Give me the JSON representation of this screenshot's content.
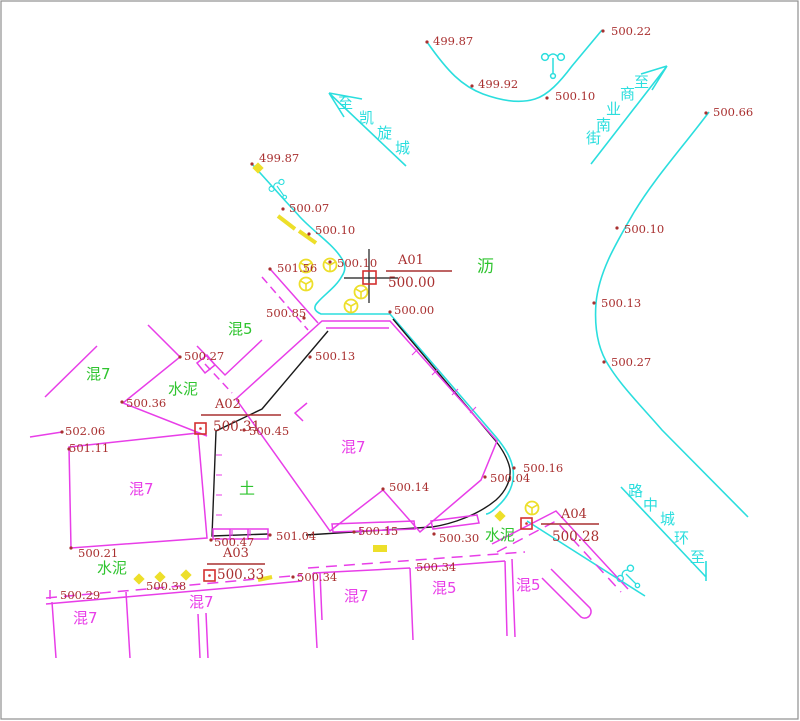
{
  "drawing_type": "cadastral-survey-plan",
  "colors": {
    "background": "#FFFFFF",
    "border": "#8F8F8F",
    "cyan_road": "#2BDEDE",
    "magenta_parcel": "#E83EE8",
    "green_surface": "#2FC42F",
    "yellow_mark": "#EDDF2A",
    "dark_red_text": "#A93030",
    "red_marker": "#D43030",
    "black_line": "#1A1A1A"
  },
  "spot_elevations": [
    {
      "value": "499.87",
      "x": 433,
      "y": 45,
      "dot": [
        427,
        42
      ]
    },
    {
      "value": "500.22",
      "x": 611,
      "y": 35,
      "dot": [
        603,
        31
      ]
    },
    {
      "value": "499.92",
      "x": 478,
      "y": 88,
      "dot": [
        472,
        86
      ]
    },
    {
      "value": "500.10",
      "x": 555,
      "y": 100,
      "dot": [
        547,
        98
      ]
    },
    {
      "value": "500.66",
      "x": 713,
      "y": 116,
      "dot": [
        706,
        113
      ]
    },
    {
      "value": "500.10",
      "x": 624,
      "y": 233,
      "dot": [
        617,
        228
      ]
    },
    {
      "value": "500.13",
      "x": 601,
      "y": 307,
      "dot": [
        594,
        303
      ]
    },
    {
      "value": "500.27",
      "x": 611,
      "y": 366,
      "dot": [
        604,
        362
      ]
    },
    {
      "value": "499.87",
      "x": 259,
      "y": 162,
      "dot": [
        252,
        164
      ]
    },
    {
      "value": "500.07",
      "x": 289,
      "y": 212,
      "dot": [
        283,
        209
      ]
    },
    {
      "value": "500.10",
      "x": 315,
      "y": 234,
      "dot": [
        309,
        234
      ]
    },
    {
      "value": "500.10",
      "x": 337,
      "y": 267,
      "dot": [
        330,
        262
      ]
    },
    {
      "value": "501.56",
      "x": 277,
      "y": 272,
      "dot": [
        270,
        269
      ]
    },
    {
      "value": "500.85",
      "x": 266,
      "y": 317,
      "dot": [
        304,
        318
      ]
    },
    {
      "value": "500.00",
      "x": 394,
      "y": 314,
      "dot": [
        390,
        312
      ]
    },
    {
      "value": "500.13",
      "x": 315,
      "y": 360,
      "dot": [
        310,
        357
      ]
    },
    {
      "value": "500.27",
      "x": 184,
      "y": 360,
      "dot": [
        180,
        357
      ]
    },
    {
      "value": "500.36",
      "x": 126,
      "y": 407,
      "dot": [
        122,
        402
      ]
    },
    {
      "value": "502.06",
      "x": 65,
      "y": 435,
      "dot": [
        62,
        432
      ]
    },
    {
      "value": "501.11",
      "x": 69,
      "y": 452,
      "dot": [
        69,
        449
      ]
    },
    {
      "value": "500.45",
      "x": 249,
      "y": 435,
      "dot": [
        244,
        430
      ]
    },
    {
      "value": "500.14",
      "x": 389,
      "y": 491,
      "dot": [
        383,
        489
      ]
    },
    {
      "value": "500.04",
      "x": 490,
      "y": 482,
      "dot": [
        485,
        477
      ]
    },
    {
      "value": "500.16",
      "x": 523,
      "y": 472,
      "dot": [
        514,
        468
      ]
    },
    {
      "value": "500.30",
      "x": 439,
      "y": 542,
      "dot": [
        434,
        534
      ]
    },
    {
      "value": "500.15",
      "x": 358,
      "y": 535,
      "dot": [
        354,
        532
      ]
    },
    {
      "value": "501.04",
      "x": 276,
      "y": 540,
      "dot": [
        270,
        535
      ]
    },
    {
      "value": "500.47",
      "x": 214,
      "y": 546,
      "dot": [
        211,
        540
      ]
    },
    {
      "value": "500.21",
      "x": 78,
      "y": 557,
      "dot": [
        71,
        548
      ]
    },
    {
      "value": "500.29",
      "x": 60,
      "y": 599
    },
    {
      "value": "500.38",
      "x": 146,
      "y": 590
    },
    {
      "value": "500.34",
      "x": 297,
      "y": 581,
      "dot": [
        293,
        577
      ]
    },
    {
      "value": "500.34",
      "x": 416,
      "y": 571
    }
  ],
  "control_points": [
    {
      "id": "A01",
      "value": "500.00",
      "label_x": 398,
      "label_y": 264,
      "line": [
        386,
        271,
        452,
        271
      ],
      "value_x": 388,
      "value_y": 287,
      "square": [
        363,
        271,
        13
      ],
      "crosshair": {
        "v": [
          369,
          249,
          369,
          303
        ],
        "h": [
          344,
          278,
          398,
          278
        ]
      }
    },
    {
      "id": "A02",
      "value": "500.31",
      "label_x": 215,
      "label_y": 408,
      "line": [
        201,
        415,
        281,
        415
      ],
      "value_x": 213,
      "value_y": 431,
      "square": [
        195,
        423,
        11
      ],
      "dot": true
    },
    {
      "id": "A03",
      "value": "500.33",
      "label_x": 223,
      "label_y": 557,
      "line": [
        207,
        564,
        265,
        564
      ],
      "value_x": 217,
      "value_y": 579,
      "square": [
        204,
        570,
        11
      ],
      "dot": true
    },
    {
      "id": "A04",
      "value": "500.28",
      "label_x": 561,
      "label_y": 518,
      "line": [
        541,
        524,
        599,
        524
      ],
      "value_x": 552,
      "value_y": 541,
      "square": [
        521,
        518,
        11
      ],
      "dot": true
    }
  ],
  "surface_labels": [
    {
      "text": "混5",
      "x": 228,
      "y": 334,
      "color": "green",
      "size": 15
    },
    {
      "text": "混7",
      "x": 86,
      "y": 379,
      "color": "green",
      "size": 15
    },
    {
      "text": "水泥",
      "x": 168,
      "y": 394,
      "color": "green",
      "size": 15
    },
    {
      "text": "沥",
      "x": 477,
      "y": 272,
      "color": "green",
      "size": 17
    },
    {
      "text": "土",
      "x": 239,
      "y": 494,
      "color": "green",
      "size": 16
    },
    {
      "text": "水泥",
      "x": 485,
      "y": 540,
      "color": "green",
      "size": 15
    },
    {
      "text": "水泥",
      "x": 97,
      "y": 573,
      "color": "green",
      "size": 15
    },
    {
      "text": "混7",
      "x": 129,
      "y": 494,
      "color": "magenta",
      "size": 15
    },
    {
      "text": "混7",
      "x": 341,
      "y": 452,
      "color": "magenta",
      "size": 15
    },
    {
      "text": "混7",
      "x": 73,
      "y": 623,
      "color": "magenta",
      "size": 15
    },
    {
      "text": "混7",
      "x": 189,
      "y": 607,
      "color": "magenta",
      "size": 15
    },
    {
      "text": "混7",
      "x": 344,
      "y": 601,
      "color": "magenta",
      "size": 15
    },
    {
      "text": "混5",
      "x": 432,
      "y": 593,
      "color": "magenta",
      "size": 15
    },
    {
      "text": "混5",
      "x": 516,
      "y": 590,
      "color": "magenta",
      "size": 15
    }
  ],
  "road_names": [
    {
      "name": "至凯旋城",
      "chars": [
        {
          "c": "至",
          "x": 338,
          "y": 108
        },
        {
          "c": "凯",
          "x": 359,
          "y": 123
        },
        {
          "c": "旋",
          "x": 377,
          "y": 138
        },
        {
          "c": "城",
          "x": 395,
          "y": 153
        }
      ]
    },
    {
      "name": "至商业南街",
      "chars": [
        {
          "c": "至",
          "x": 634,
          "y": 87
        },
        {
          "c": "商",
          "x": 620,
          "y": 99
        },
        {
          "c": "业",
          "x": 606,
          "y": 114
        },
        {
          "c": "南",
          "x": 596,
          "y": 130
        },
        {
          "c": "街",
          "x": 586,
          "y": 143
        }
      ]
    },
    {
      "name": "至环城中路",
      "chars": [
        {
          "c": "路",
          "x": 628,
          "y": 496
        },
        {
          "c": "中",
          "x": 643,
          "y": 510
        },
        {
          "c": "城",
          "x": 660,
          "y": 524
        },
        {
          "c": "环",
          "x": 674,
          "y": 543
        },
        {
          "c": "至",
          "x": 690,
          "y": 562
        }
      ]
    }
  ],
  "symbols": {
    "streetlights": [
      {
        "x": 277,
        "y": 186,
        "rotate": -35,
        "scale": 0.75
      },
      {
        "x": 553,
        "y": 58,
        "rotate": 0,
        "scale": 1
      },
      {
        "x": 626,
        "y": 574,
        "rotate": -45,
        "scale": 0.9
      }
    ],
    "wells": [
      [
        306,
        266
      ],
      [
        330,
        265
      ],
      [
        306,
        284
      ],
      [
        361,
        292
      ],
      [
        351,
        306
      ],
      [
        532,
        508
      ]
    ],
    "diamonds": [
      [
        258,
        168
      ],
      [
        500,
        516
      ],
      [
        139,
        579
      ],
      [
        160,
        577
      ],
      [
        186,
        575
      ]
    ],
    "dashes": [
      [
        278,
        216,
        295,
        229
      ],
      [
        299,
        231,
        316,
        243
      ],
      [
        258,
        580,
        272,
        577
      ]
    ],
    "rects": [
      [
        373,
        545,
        14,
        7
      ]
    ]
  }
}
